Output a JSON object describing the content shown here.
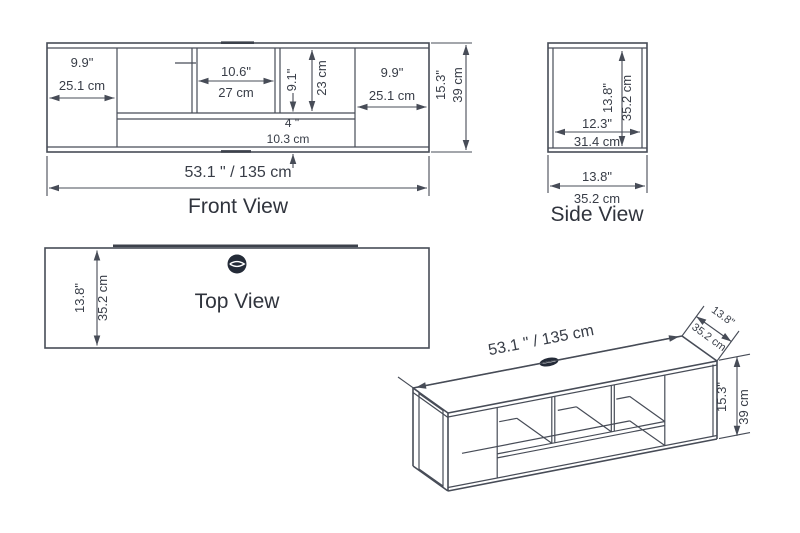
{
  "colors": {
    "line": "#474c57",
    "text": "#383d47",
    "grommet": "#242b38",
    "background": "#ffffff"
  },
  "views": {
    "front": {
      "label": "Front View",
      "dim_left_width_in": "9.9\"",
      "dim_left_width_cm": "25.1 cm",
      "dim_middle_width_in": "10.6\"",
      "dim_middle_width_cm": "27 cm",
      "dim_inner_height_in": "9.1\"",
      "dim_inner_height_cm": "23 cm",
      "dim_bottom_gap_in": "4 \"",
      "dim_bottom_gap_cm": "10.3 cm",
      "dim_right_width_in": "9.9\"",
      "dim_right_width_cm": "25.1 cm",
      "dim_total_height_in": "15.3\"",
      "dim_total_height_cm": "39 cm",
      "dim_total_width": "53.1 \" / 135 cm"
    },
    "side": {
      "label": "Side View",
      "dim_inner_height_in": "13.8\"",
      "dim_inner_height_cm": "35.2 cm",
      "dim_inner_depth_in": "12.3\"",
      "dim_inner_depth_cm": "31.4 cm",
      "dim_total_depth_in": "13.8\"",
      "dim_total_depth_cm": "35.2 cm"
    },
    "top": {
      "label": "Top View",
      "dim_depth_in": "13.8\"",
      "dim_depth_cm": "35.2 cm"
    },
    "perspective": {
      "dim_total_width": "53.1 \" / 135 cm",
      "dim_depth_in": "13.8\"",
      "dim_depth_cm": "35.2 cm",
      "dim_height_in": "15.3\"",
      "dim_height_cm": "39 cm"
    }
  }
}
